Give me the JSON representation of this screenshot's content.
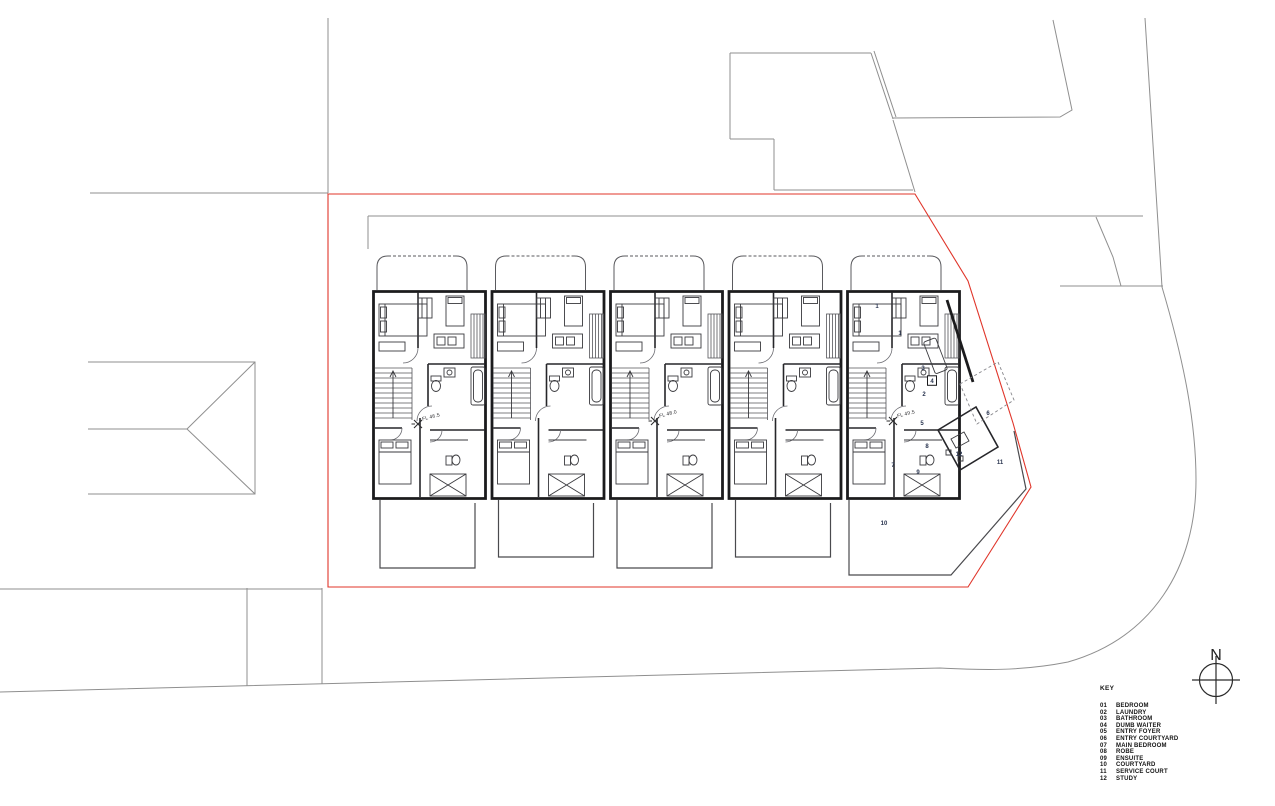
{
  "colors": {
    "wall": "#1b1b1d",
    "context": "#8f8f8f",
    "boundary": "#e0352a",
    "room_label": "#2a3550"
  },
  "north": {
    "label": "N"
  },
  "key": {
    "title": "KEY",
    "items": [
      {
        "code": "01",
        "label": "BEDROOM"
      },
      {
        "code": "02",
        "label": "LAUNDRY"
      },
      {
        "code": "03",
        "label": "BATHROOM"
      },
      {
        "code": "04",
        "label": "DUMB WAITER"
      },
      {
        "code": "05",
        "label": "ENTRY FOYER"
      },
      {
        "code": "06",
        "label": "ENTRY COURTYARD"
      },
      {
        "code": "07",
        "label": "MAIN BEDROOM"
      },
      {
        "code": "08",
        "label": "ROBE"
      },
      {
        "code": "09",
        "label": "ENSUITE"
      },
      {
        "code": "10",
        "label": "COURTYARD"
      },
      {
        "code": "11",
        "label": "SERVICE COURT"
      },
      {
        "code": "12",
        "label": "STUDY"
      }
    ]
  },
  "plan": {
    "floor_levels": [
      {
        "label": "FL 46.5",
        "x": 418,
        "y": 424
      },
      {
        "label": "FL 48.0",
        "x": 655,
        "y": 421
      },
      {
        "label": "FL 49.5",
        "x": 893,
        "y": 421
      }
    ],
    "room_numbers": [
      {
        "n": "1",
        "x": 877,
        "y": 306
      },
      {
        "n": "1",
        "x": 900,
        "y": 333
      },
      {
        "n": "3",
        "x": 923,
        "y": 368
      },
      {
        "n": "4",
        "x": 932,
        "y": 381,
        "boxed": true
      },
      {
        "n": "2",
        "x": 924,
        "y": 394
      },
      {
        "n": "5",
        "x": 922,
        "y": 423
      },
      {
        "n": "6",
        "x": 988,
        "y": 413
      },
      {
        "n": "7",
        "x": 893,
        "y": 465
      },
      {
        "n": "8",
        "x": 927,
        "y": 446
      },
      {
        "n": "9",
        "x": 918,
        "y": 472
      },
      {
        "n": "12",
        "x": 959,
        "y": 454
      },
      {
        "n": "11",
        "x": 1000,
        "y": 462
      },
      {
        "n": "10",
        "x": 884,
        "y": 523
      }
    ]
  }
}
